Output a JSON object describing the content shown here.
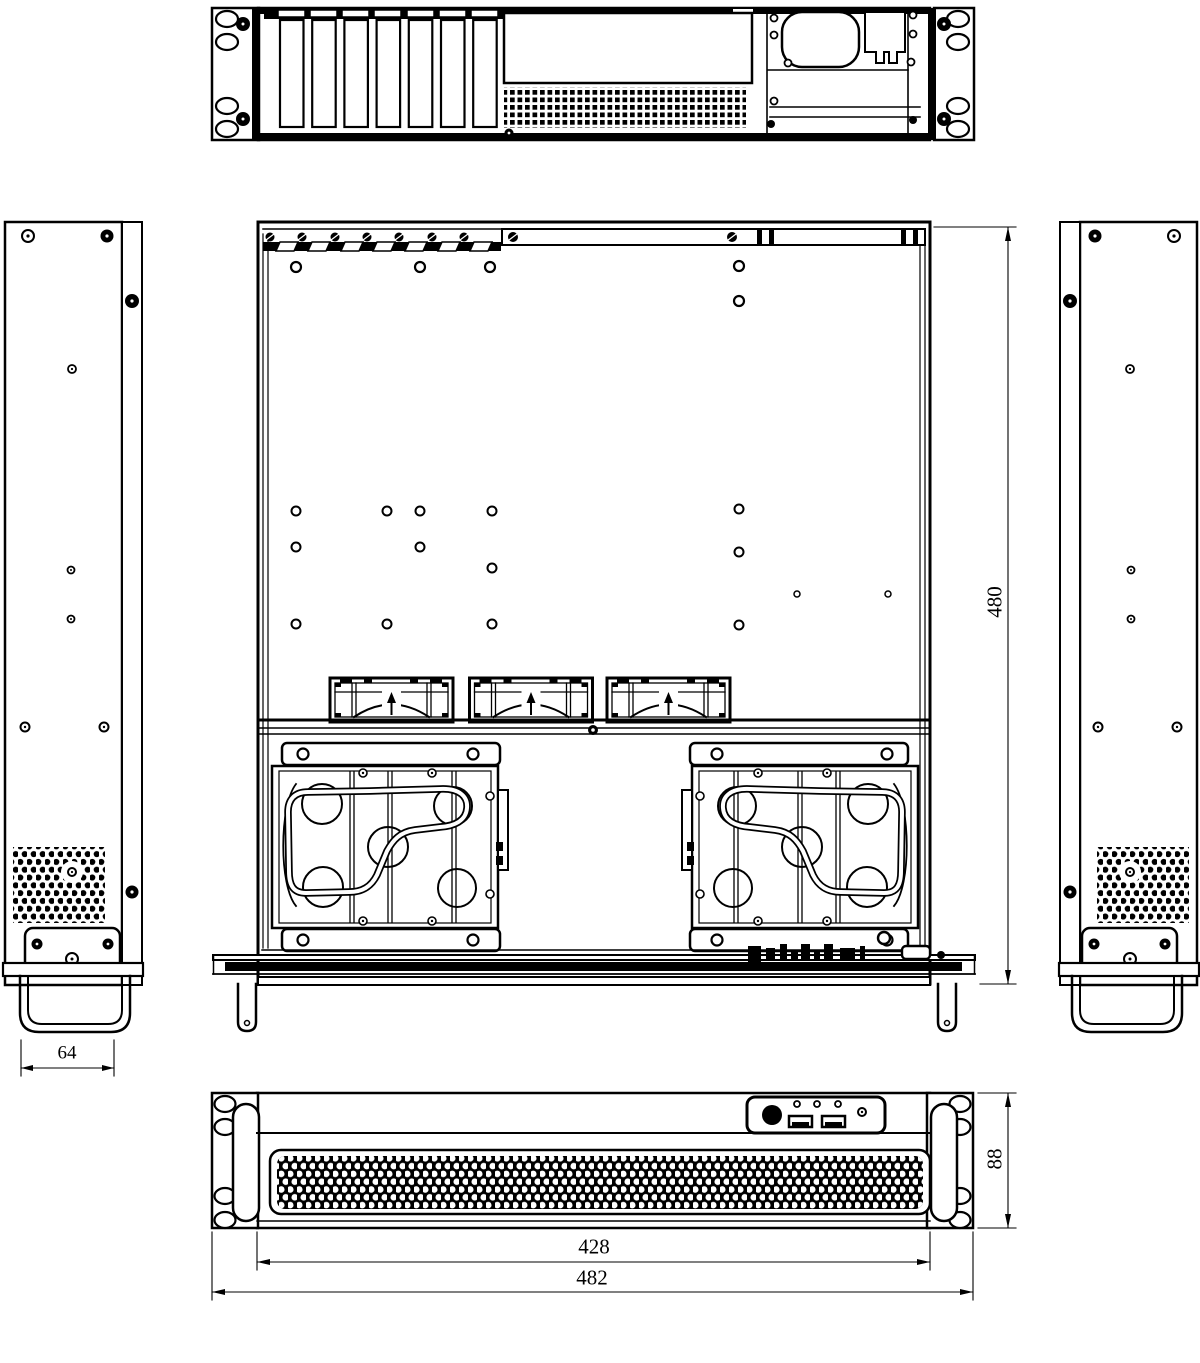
{
  "drawing": {
    "type": "engineering-drawing",
    "subject": "2U rackmount server chassis, five orthographic views",
    "background": "#ffffff",
    "line_color": "#000000",
    "views": [
      "rear",
      "side-left",
      "plan",
      "side-right",
      "front"
    ],
    "counts": {
      "expansion_slots": 7,
      "fans": 3,
      "drive_trays": 2,
      "usb_ports": 2
    }
  },
  "dimensions": {
    "handle_width": "64",
    "chassis_depth": "480",
    "front_inner_width": "428",
    "front_overall_width": "482",
    "front_height": "88"
  }
}
